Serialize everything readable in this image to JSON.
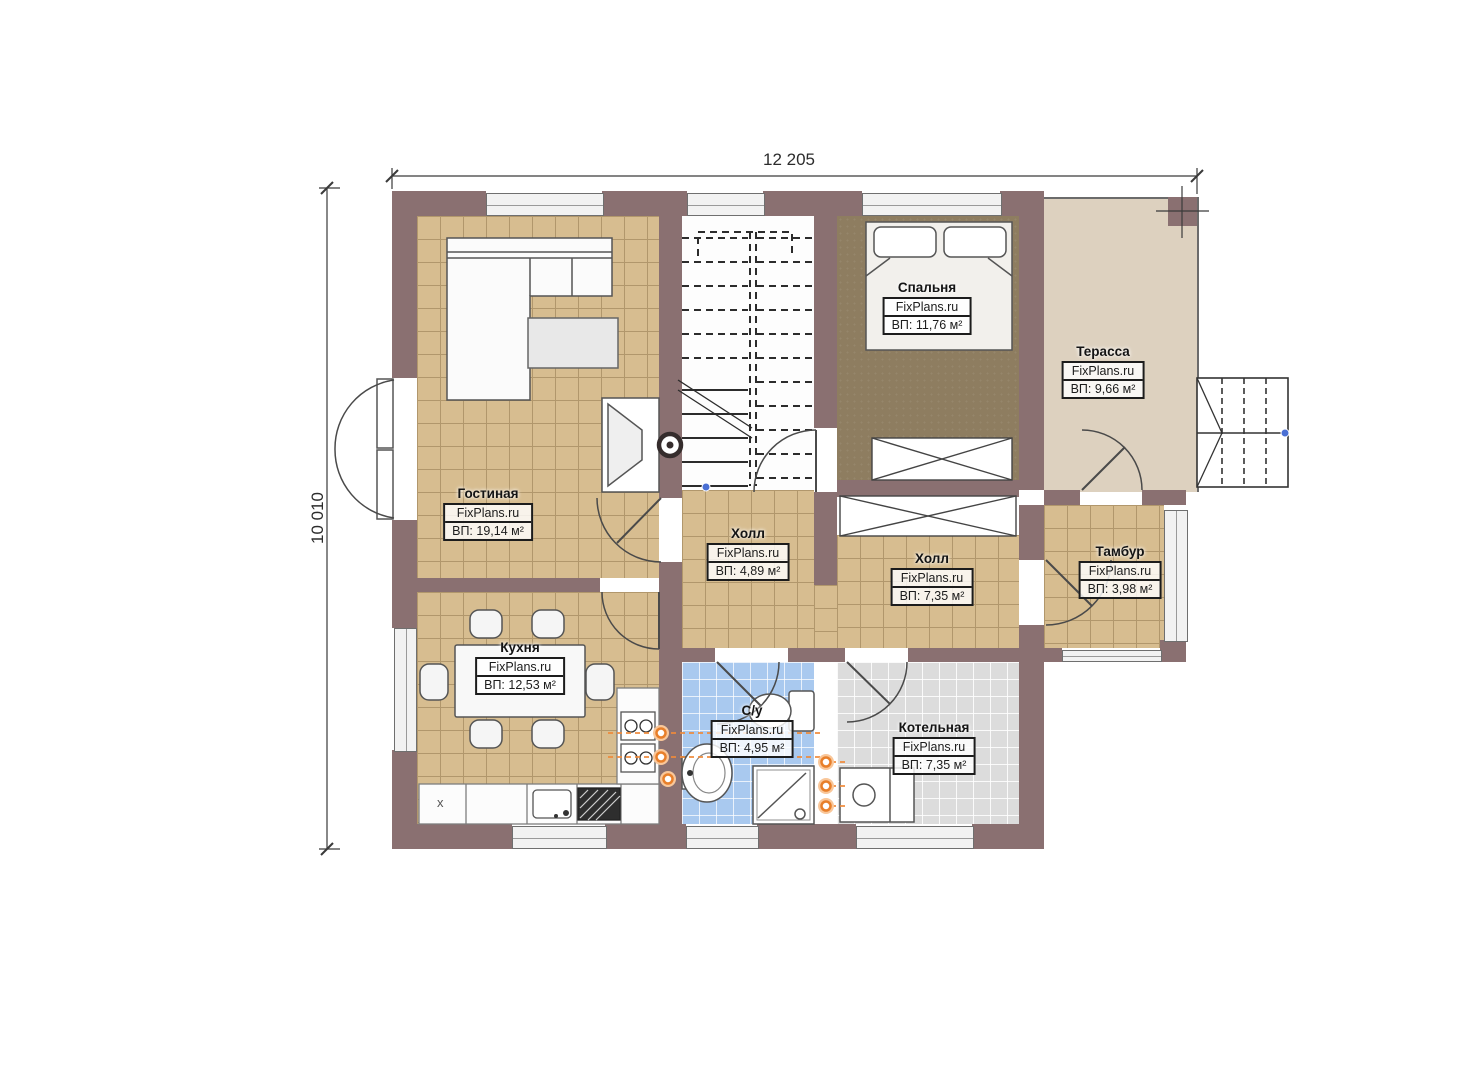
{
  "dimensions": {
    "width_label": "12 205",
    "height_label": "10 010"
  },
  "watermark": "FixPlans.ru",
  "rooms": [
    {
      "name": "Гостиная",
      "area": "ВП: 19,14 м²"
    },
    {
      "name": "Кухня",
      "area": "ВП: 12,53 м²"
    },
    {
      "name": "Холл",
      "area": "ВП: 4,89 м²"
    },
    {
      "name": "Спальня",
      "area": "ВП: 11,76 м²"
    },
    {
      "name": "Терасса",
      "area": "ВП: 9,66 м²"
    },
    {
      "name": "Холл",
      "area": "ВП: 7,35 м²"
    },
    {
      "name": "Тамбур",
      "area": "ВП: 3,98 м²"
    },
    {
      "name": "С/у",
      "area": "ВП: 4,95 м²"
    },
    {
      "name": "Котельная",
      "area": "ВП: 7,35 м²"
    }
  ],
  "annotations": {
    "counter_mark": "x"
  },
  "colors": {
    "wall": "#8a7071",
    "floor_tile": "#d7bd90",
    "bedroom_floor": "#8e7d60",
    "terrace_floor": "#ddd1bf",
    "bathroom_floor": "#a9c9ef",
    "boiler_floor": "#dcdcdc",
    "plumbing_accent": "#e87f2a"
  }
}
